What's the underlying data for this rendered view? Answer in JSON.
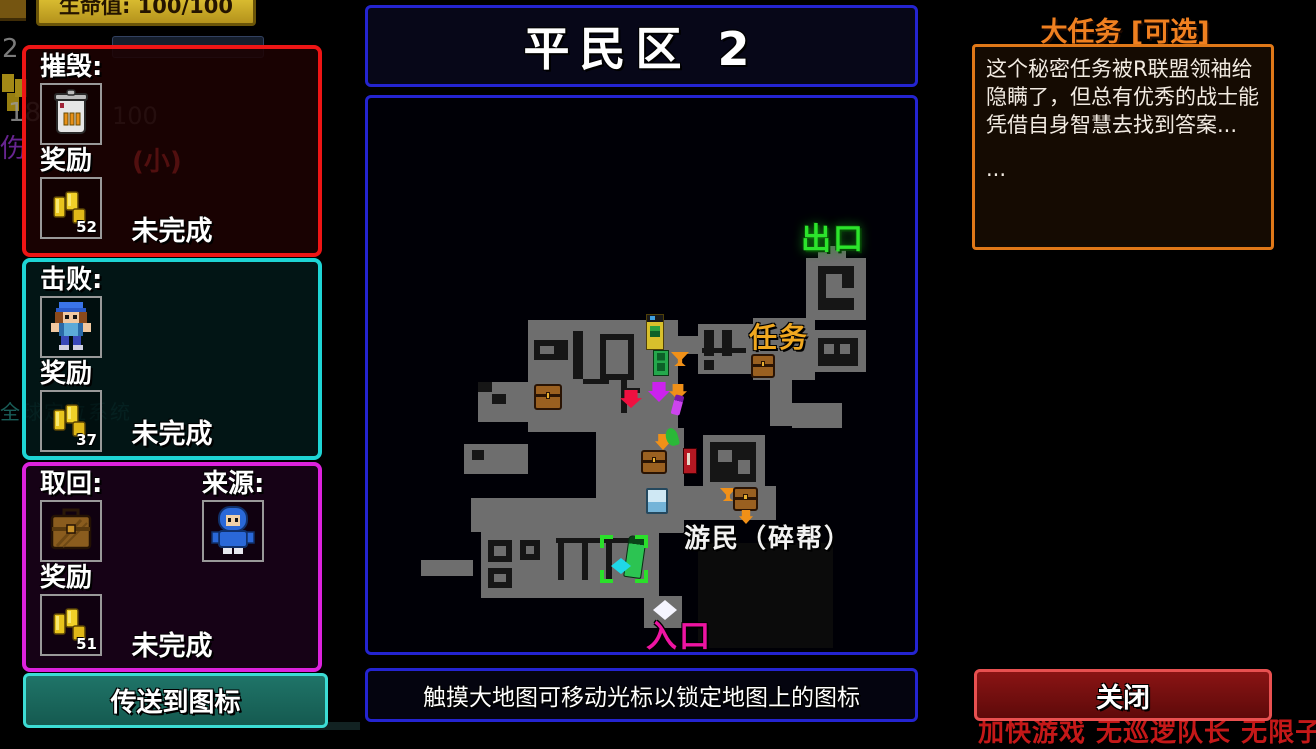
{
  "hud": {
    "health": "生命值: 100/100",
    "bg_level": "2",
    "bg_ammo": "18",
    "bg_ammo_max": "100",
    "bg_damage": "伤",
    "bg_small": "(小)",
    "bg_gps": "全球定位系统"
  },
  "missions": [
    {
      "action_label": "摧毁:",
      "reward_label": "奖励",
      "reward_amount": "52",
      "status": "未完成",
      "target_icon": "trash-can-icon"
    },
    {
      "action_label": "击败:",
      "reward_label": "奖励",
      "reward_amount": "37",
      "status": "未完成",
      "target_icon": "enemy-character-icon"
    },
    {
      "action_label": "取回:",
      "source_label": "来源:",
      "reward_label": "奖励",
      "reward_amount": "51",
      "status": "未完成",
      "target_icon": "briefcase-icon",
      "source_icon": "hooded-character-icon"
    }
  ],
  "teleport_button": {
    "label": "传送到图标"
  },
  "map": {
    "title": "平民区 2",
    "hint": "触摸大地图可移动光标以锁定地图上的图标",
    "labels": [
      {
        "text": "出口",
        "x": 433,
        "y": 116,
        "size": 30,
        "color": "#2ce42c",
        "glow": true
      },
      {
        "text": "任务",
        "x": 381,
        "y": 218,
        "size": 28,
        "color": "#f0a820"
      },
      {
        "text": "游民（碎帮）",
        "x": 316,
        "y": 420,
        "size": 26,
        "color": "#f2f2f2"
      },
      {
        "text": "入口",
        "x": 278,
        "y": 513,
        "size": 31,
        "color": "#ee14a2"
      }
    ],
    "rooms": [
      {
        "x": 330,
        "y": 445,
        "w": 135,
        "h": 105,
        "c": "#0b0b0b"
      },
      {
        "x": 450,
        "y": 148,
        "w": 28,
        "h": 16
      },
      {
        "x": 438,
        "y": 160,
        "w": 60,
        "h": 62
      },
      {
        "x": 443,
        "y": 232,
        "w": 55,
        "h": 42
      },
      {
        "x": 385,
        "y": 220,
        "w": 62,
        "h": 62
      },
      {
        "x": 330,
        "y": 226,
        "w": 55,
        "h": 50
      },
      {
        "x": 160,
        "y": 222,
        "w": 150,
        "h": 112
      },
      {
        "x": 308,
        "y": 238,
        "w": 24,
        "h": 18
      },
      {
        "x": 402,
        "y": 278,
        "w": 22,
        "h": 50
      },
      {
        "x": 424,
        "y": 305,
        "w": 50,
        "h": 25
      },
      {
        "x": 335,
        "y": 337,
        "w": 62,
        "h": 52
      },
      {
        "x": 266,
        "y": 330,
        "w": 50,
        "h": 105
      },
      {
        "x": 316,
        "y": 388,
        "w": 92,
        "h": 34
      },
      {
        "x": 103,
        "y": 400,
        "w": 165,
        "h": 34
      },
      {
        "x": 113,
        "y": 434,
        "w": 178,
        "h": 66
      },
      {
        "x": 53,
        "y": 462,
        "w": 52,
        "h": 16
      },
      {
        "x": 276,
        "y": 498,
        "w": 38,
        "h": 32
      },
      {
        "x": 110,
        "y": 284,
        "w": 58,
        "h": 40
      },
      {
        "x": 96,
        "y": 346,
        "w": 64,
        "h": 30
      },
      {
        "x": 228,
        "y": 334,
        "w": 40,
        "h": 70
      }
    ],
    "walls": [
      {
        "x": 450,
        "y": 168,
        "w": 36,
        "h": 44
      },
      {
        "x": 458,
        "y": 176,
        "w": 16,
        "h": 24,
        "c": "#6e6e6e"
      },
      {
        "x": 474,
        "y": 190,
        "w": 12,
        "h": 10,
        "c": "#6e6e6e"
      },
      {
        "x": 450,
        "y": 240,
        "w": 40,
        "h": 28
      },
      {
        "x": 456,
        "y": 246,
        "w": 10,
        "h": 10,
        "c": "#6e6e6e"
      },
      {
        "x": 472,
        "y": 246,
        "w": 10,
        "h": 10,
        "c": "#6e6e6e"
      },
      {
        "x": 336,
        "y": 232,
        "w": 10,
        "h": 26
      },
      {
        "x": 354,
        "y": 232,
        "w": 10,
        "h": 26
      },
      {
        "x": 334,
        "y": 250,
        "w": 44,
        "h": 5
      },
      {
        "x": 336,
        "y": 262,
        "w": 10,
        "h": 10
      },
      {
        "x": 166,
        "y": 242,
        "w": 34,
        "h": 20
      },
      {
        "x": 172,
        "y": 248,
        "w": 14,
        "h": 8,
        "c": "#6e6e6e"
      },
      {
        "x": 205,
        "y": 233,
        "w": 10,
        "h": 48
      },
      {
        "x": 232,
        "y": 236,
        "w": 34,
        "h": 46
      },
      {
        "x": 238,
        "y": 242,
        "w": 22,
        "h": 34,
        "c": "#6e6e6e"
      },
      {
        "x": 215,
        "y": 281,
        "w": 26,
        "h": 5
      },
      {
        "x": 253,
        "y": 281,
        "w": 6,
        "h": 34
      },
      {
        "x": 258,
        "y": 290,
        "w": 14,
        "h": 5
      },
      {
        "x": 342,
        "y": 344,
        "w": 46,
        "h": 40
      },
      {
        "x": 350,
        "y": 352,
        "w": 14,
        "h": 12,
        "c": "#6e6e6e"
      },
      {
        "x": 370,
        "y": 362,
        "w": 12,
        "h": 14,
        "c": "#6e6e6e"
      },
      {
        "x": 110,
        "y": 284,
        "w": 14,
        "h": 10
      },
      {
        "x": 124,
        "y": 296,
        "w": 14,
        "h": 10
      },
      {
        "x": 104,
        "y": 352,
        "w": 12,
        "h": 10
      },
      {
        "x": 120,
        "y": 442,
        "w": 24,
        "h": 22
      },
      {
        "x": 126,
        "y": 448,
        "w": 12,
        "h": 10,
        "c": "#6e6e6e"
      },
      {
        "x": 152,
        "y": 442,
        "w": 20,
        "h": 20
      },
      {
        "x": 158,
        "y": 448,
        "w": 8,
        "h": 8,
        "c": "#6e6e6e"
      },
      {
        "x": 120,
        "y": 470,
        "w": 24,
        "h": 20
      },
      {
        "x": 126,
        "y": 476,
        "w": 12,
        "h": 8,
        "c": "#6e6e6e"
      },
      {
        "x": 188,
        "y": 440,
        "w": 80,
        "h": 5
      },
      {
        "x": 190,
        "y": 440,
        "w": 6,
        "h": 42
      },
      {
        "x": 214,
        "y": 440,
        "w": 6,
        "h": 42
      },
      {
        "x": 238,
        "y": 440,
        "w": 6,
        "h": 42
      }
    ],
    "icons": [
      {
        "name": "vending-machine-yellow",
        "x": 278,
        "y": 216,
        "w": 18,
        "h": 36
      },
      {
        "name": "machine-green",
        "x": 285,
        "y": 252,
        "w": 16,
        "h": 26
      },
      {
        "name": "funnel-orange",
        "x": 303,
        "y": 254,
        "w": 18,
        "h": 14
      },
      {
        "name": "chest",
        "x": 166,
        "y": 286,
        "w": 28,
        "h": 26
      },
      {
        "name": "arrow-red",
        "x": 252,
        "y": 292,
        "w": 22,
        "h": 18
      },
      {
        "name": "arrow-magenta",
        "x": 280,
        "y": 284,
        "w": 22,
        "h": 20
      },
      {
        "name": "arrow-orange",
        "x": 301,
        "y": 286,
        "w": 18,
        "h": 16
      },
      {
        "name": "syringe-purple",
        "x": 305,
        "y": 297,
        "w": 9,
        "h": 20
      },
      {
        "name": "chest",
        "x": 383,
        "y": 256,
        "w": 24,
        "h": 24
      },
      {
        "name": "arrow-orange",
        "x": 287,
        "y": 336,
        "w": 16,
        "h": 16
      },
      {
        "name": "sprout-green",
        "x": 298,
        "y": 330,
        "w": 12,
        "h": 18
      },
      {
        "name": "chest",
        "x": 273,
        "y": 352,
        "w": 26,
        "h": 24
      },
      {
        "name": "machine-red",
        "x": 315,
        "y": 350,
        "w": 14,
        "h": 26
      },
      {
        "name": "locker-blue",
        "x": 278,
        "y": 390,
        "w": 22,
        "h": 26
      },
      {
        "name": "funnel-orange",
        "x": 352,
        "y": 390,
        "w": 16,
        "h": 13
      },
      {
        "name": "chest",
        "x": 365,
        "y": 389,
        "w": 25,
        "h": 24
      },
      {
        "name": "arrow-orange",
        "x": 371,
        "y": 412,
        "w": 14,
        "h": 14
      },
      {
        "name": "bottle-green",
        "x": 258,
        "y": 438,
        "w": 18,
        "h": 42
      },
      {
        "name": "target-brackets-green",
        "x": 232,
        "y": 437,
        "w": 48,
        "h": 48
      },
      {
        "name": "diamond-cyan",
        "x": 243,
        "y": 460,
        "w": 20,
        "h": 16
      },
      {
        "name": "diamond-white",
        "x": 285,
        "y": 502,
        "w": 24,
        "h": 20
      }
    ]
  },
  "side_quest": {
    "title": "大任务 [可选]",
    "body": "这个秘密任务被R联盟领袖给隐瞒了，但总有优秀的战士能凭借自身智慧去找到答案...",
    "body_more": "...",
    "close_label": "关闭",
    "cheat_text": "加快游戏 无巡逻队长 无限子弹"
  }
}
